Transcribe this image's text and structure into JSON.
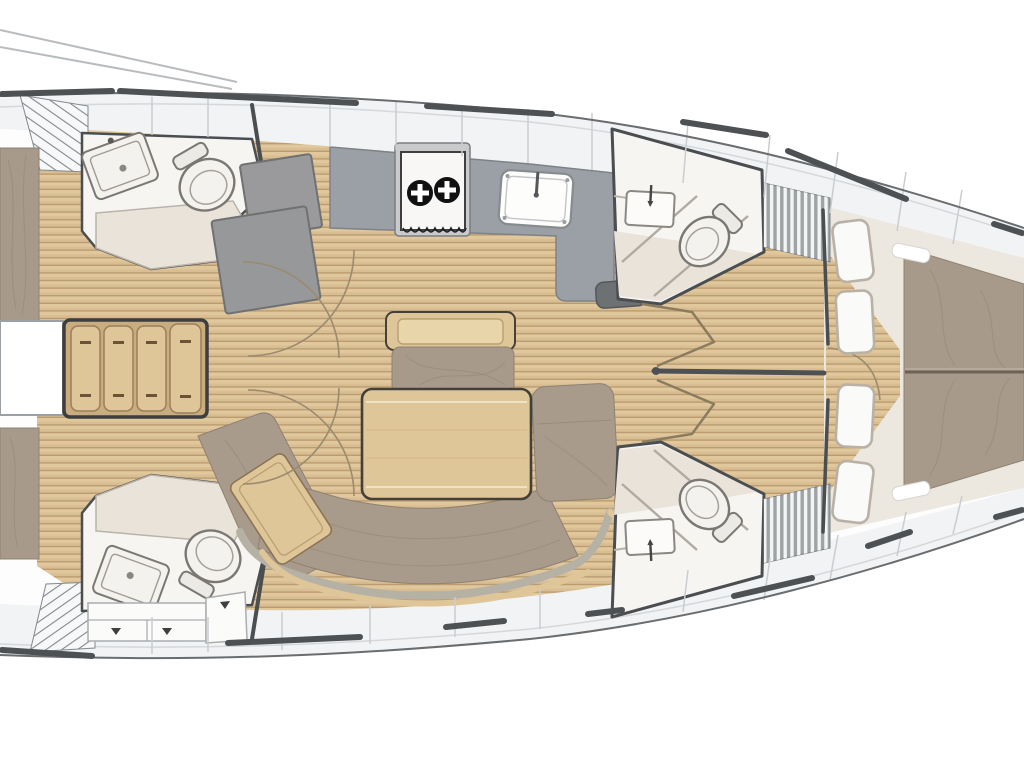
{
  "document": {
    "title": "Sailboat interior layout plan",
    "type": "yacht-floorplan-top-view",
    "orientation": "bow-right"
  },
  "rooms": [
    {
      "id": "aft-cabin-port",
      "label": "Aft cabin (port)",
      "furniture": [
        "double berth"
      ]
    },
    {
      "id": "aft-cabin-starboard",
      "label": "Aft cabin (starboard)",
      "furniture": [
        "double berth"
      ]
    },
    {
      "id": "aft-head-port",
      "label": "Aft head (port)",
      "furniture": [
        "sink",
        "toilet",
        "shower stall"
      ]
    },
    {
      "id": "aft-head-starboard",
      "label": "Aft head (starboard)",
      "furniture": [
        "sink",
        "toilet",
        "shower floor",
        "drawer lockers"
      ]
    },
    {
      "id": "companionway",
      "label": "Companionway",
      "furniture": [
        "4 wooden steps",
        "engine compartment"
      ]
    },
    {
      "id": "galley",
      "label": "Galley",
      "furniture": [
        "2-burner gimbaled stove",
        "sink",
        "L-counter"
      ]
    },
    {
      "id": "salon",
      "label": "Salon",
      "furniture": [
        "dining table",
        "mast bench",
        "C-shaped settee",
        "chaise panel"
      ]
    },
    {
      "id": "forward-head-port",
      "label": "Forward head (port)",
      "furniture": [
        "sink",
        "toilet",
        "glass partition",
        "louvered locker"
      ]
    },
    {
      "id": "forward-head-starboard",
      "label": "Forward head (starboard)",
      "furniture": [
        "sink",
        "toilet",
        "glass partition",
        "louvered locker"
      ]
    },
    {
      "id": "forward-cabin",
      "label": "Forward cabin",
      "furniture": [
        "V-berth double mattress",
        "4 side seat cushions"
      ]
    }
  ],
  "equipment_counts": {
    "heads": 4,
    "stove_burners": 2,
    "companionway_steps": 4,
    "forward_seat_cushions": 4,
    "aft_berths": 2
  },
  "colors": {
    "background": "#ffffff",
    "hull_line": "#6a6d70",
    "rail": "#4e5154",
    "deck_band": "#f1f3f5",
    "deck_line": "#d5d8db",
    "band_divider": "#c9cdd1",
    "wall": "#4b4e51",
    "wood_floor": "#d9be93",
    "wood_floor_light": "#e0c79c",
    "wood_stripe": "#bb9c6f",
    "wood_light": "#dfc698",
    "step_edge": "#9a7f58",
    "counter_gray": "#9aa0a5",
    "counter_edge": "#7e8286",
    "shower_gray": "#9a9a9c",
    "shower_gray_dark": "#921",
    "cushion": "#a89b8b",
    "backrest": "#b5b1a5",
    "mattress": "#a79a8a",
    "mattress_edge": "#8f8272",
    "cream_floor": "#ece7df",
    "head_floor": "#f6f5f2",
    "shower_floor": "#eae3da",
    "fixture_white": "#f4f2ef",
    "fixture_line": "#7b7873",
    "seat_white": "#fafaf9",
    "seat_border": "#b9b1a5",
    "arc": "#9b8a6e",
    "wrinkle": "#8f8273",
    "louver_base": "#9fa3a6",
    "louver_slat": "#f3f4f4",
    "drawer_face": "#fbfbfa",
    "table_outline": "#433f39"
  }
}
